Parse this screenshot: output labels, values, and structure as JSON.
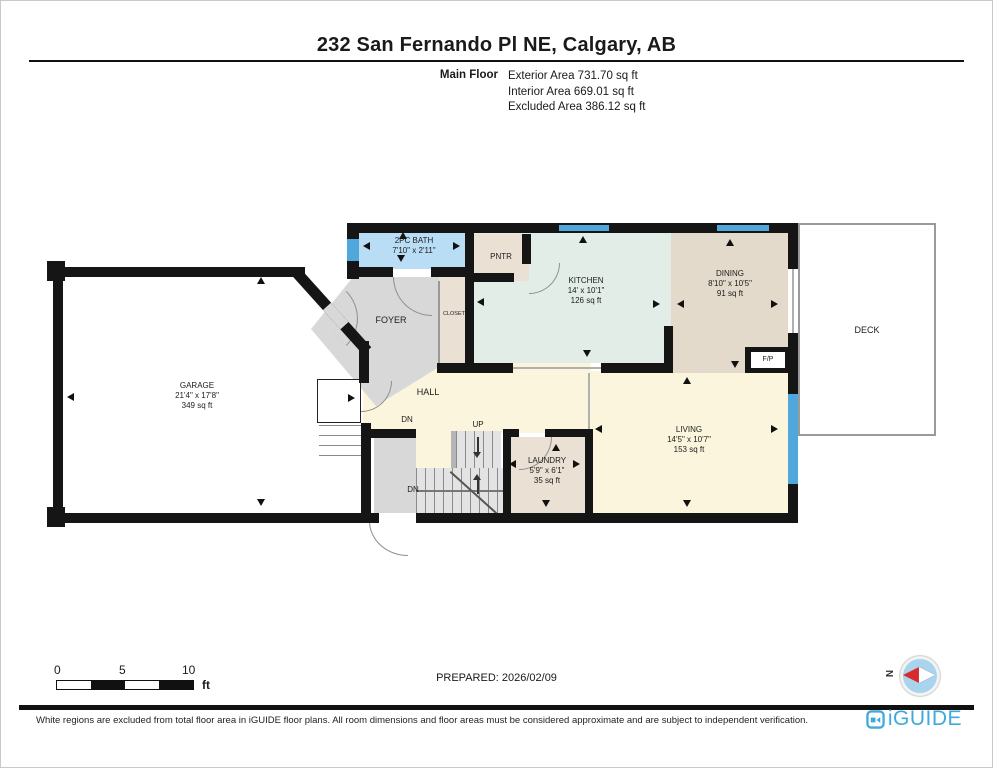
{
  "header": {
    "title": "232 San Fernando Pl NE, Calgary, AB",
    "floor_label": "Main Floor",
    "areas": [
      "Exterior Area 731.70 sq ft",
      "Interior Area 669.01 sq ft",
      "Excluded Area 386.12 sq ft"
    ]
  },
  "plan": {
    "rooms": {
      "bath": {
        "name": "2PC BATH",
        "dims": "7'10\" x 2'11\""
      },
      "pntr": {
        "name": "PNTR"
      },
      "kitchen": {
        "name": "KITCHEN",
        "dims": "14' x 10'1\"",
        "area": "126 sq ft"
      },
      "dining": {
        "name": "DINING",
        "dims": "8'10\" x 10'5\"",
        "area": "91 sq ft"
      },
      "deck": {
        "name": "DECK"
      },
      "foyer": {
        "name": "FOYER"
      },
      "closet": {
        "name": "CLOSET"
      },
      "hall": {
        "name": "HALL"
      },
      "garage": {
        "name": "GARAGE",
        "dims": "21'4\" x 17'8\"",
        "area": "349 sq ft"
      },
      "living": {
        "name": "LIVING",
        "dims": "14'5\" x 10'7\"",
        "area": "153 sq ft"
      },
      "laundry": {
        "name": "LAUNDRY",
        "dims": "5'9\" x 6'1\"",
        "area": "35 sq ft"
      },
      "fireplace": {
        "name": "F/P"
      }
    },
    "stairs": {
      "up": "UP",
      "dn1": "DN",
      "dn2": "DN"
    }
  },
  "scale_bar": {
    "start": "0",
    "mid": "5",
    "end": "10",
    "unit": "ft"
  },
  "prepared": "PREPARED: 2026/02/09",
  "compass": {
    "north": "N"
  },
  "footer": {
    "disclaimer": "White regions are excluded from total floor area in iGUIDE floor plans. All room dimensions and floor areas must be considered approximate and are subject to independent verification.",
    "brand": "iGUIDE"
  },
  "colors": {
    "wall": "#151515",
    "window_blue": "#4FA7DC",
    "bath_blue": "#B9DDF5",
    "kitchen_green": "#E3EDE7",
    "dining_tan": "#E4DACB",
    "floor_cream": "#FBF5DD",
    "foyer_gray": "#D8D8D8",
    "storage_beige": "#EAE0D4",
    "compass_red": "#D92B2B",
    "brand_blue": "#3FA9DC"
  }
}
